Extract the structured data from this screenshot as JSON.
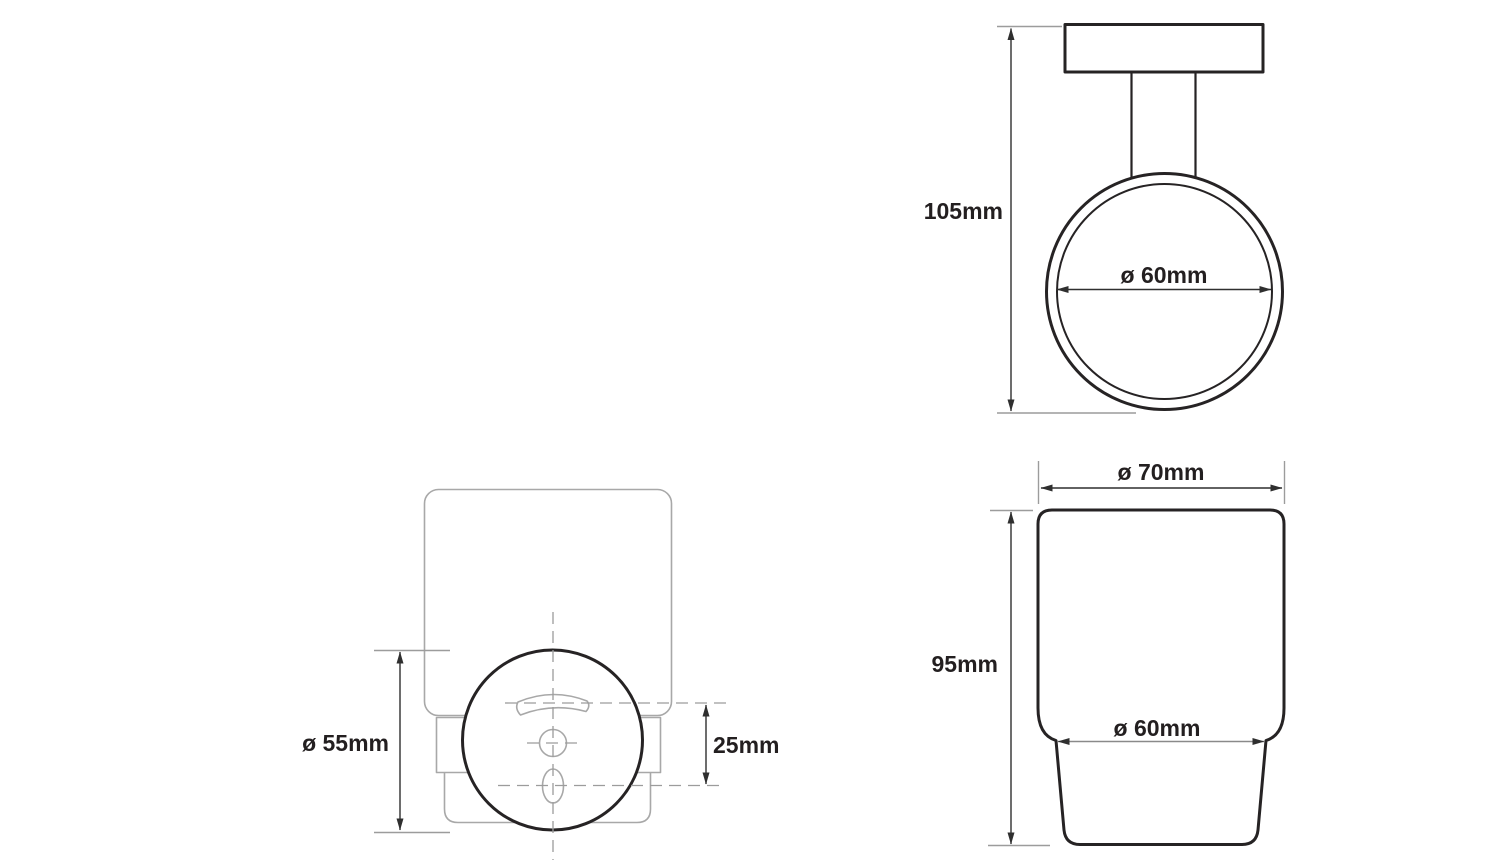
{
  "page": {
    "background": "#ffffff"
  },
  "drawing": {
    "colors": {
      "primary_line": "#262324",
      "secondary_line": "#a8a8a8",
      "dimension_line": "#2f2f2f",
      "extension_line": "#9c9c9c",
      "centerline": "#9c9c9c",
      "text": "#231f20"
    },
    "views": {
      "holder_front": {
        "height_label": "105mm",
        "ring_inner_diameter_label": "ø 60mm"
      },
      "cup_front": {
        "rim_diameter_label": "ø 70mm",
        "height_label": "95mm",
        "body_diameter_label": "ø 60mm"
      },
      "mount_rear": {
        "plate_diameter_label": "ø 55mm",
        "hole_spacing_label": "25mm"
      }
    }
  }
}
